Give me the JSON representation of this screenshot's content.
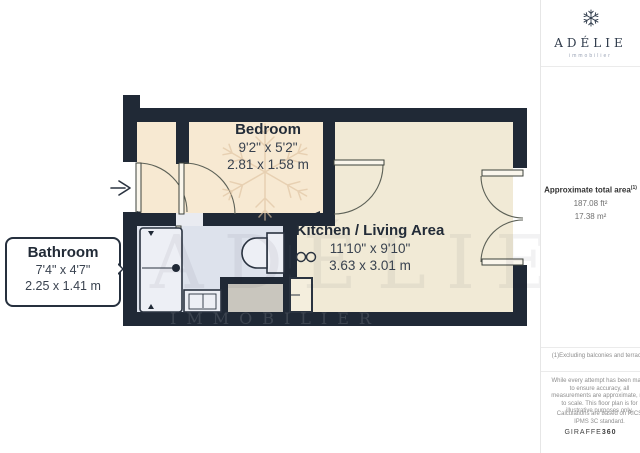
{
  "brand": {
    "name": "ADÉLIE",
    "tagline": "immobilier"
  },
  "sidebar": {
    "area": {
      "label": "Approximate total area",
      "sup": "(1)",
      "imperial": "187.08 ft²",
      "metric": "17.38 m²"
    },
    "footnote": "(1)Excluding balconies and terraces",
    "disclaimer": "While every attempt has been made to ensure accuracy, all measurements are approximate, not to scale. This floor plan is for illustrative purposes only.",
    "standard": "Calculations are based on RICS IPMS 3C standard.",
    "provider": {
      "name": "GIRAFFE",
      "suffix": "360"
    }
  },
  "floorplan": {
    "rooms": [
      {
        "name": "Bedroom",
        "imperial": "9'2\" x 5'2\"",
        "metric": "2.81 x 1.58 m"
      },
      {
        "name": "Kitchen / Living Area",
        "imperial": "11'10\" x 9'10\"",
        "metric": "3.63 x 3.01 m"
      },
      {
        "name": "Bathroom",
        "imperial": "7'4\" x 4'7\"",
        "metric": "2.25 x 1.41 m"
      }
    ],
    "watermark": {
      "brand": "ADÉLIE",
      "sub": "IMMOBILIER"
    },
    "colors": {
      "wall": "#202936",
      "floor_main": "#f7e9d2",
      "floor_kitchen": "#f1ead6",
      "floor_bathroom": "#dde2ec",
      "floor_utility": "#c9c6be",
      "fixture_fill": "#edeff5",
      "accent_text": "#232c38"
    }
  }
}
